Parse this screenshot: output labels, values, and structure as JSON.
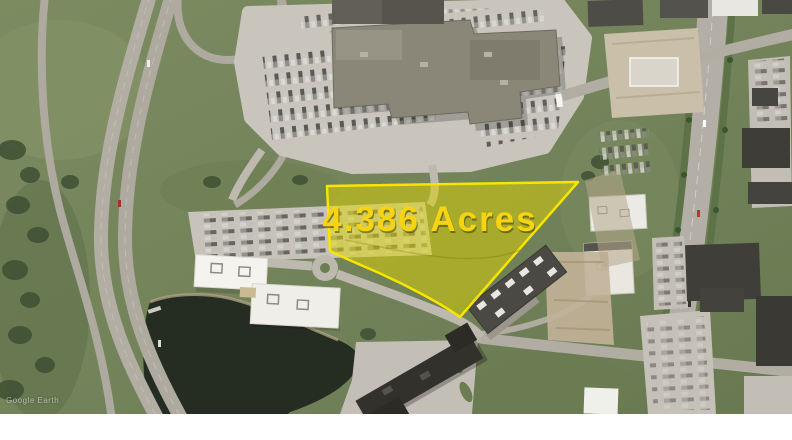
{
  "annotation": {
    "acreage_label": "4.386 Acres",
    "label_color": "#f6d411",
    "label_shadow_color": "#3c3c10",
    "outline_color": "#f8e400",
    "fill_color": "#ded400",
    "fill_opacity": "0.5",
    "parcel_path": "M327,186 L578,182 L460,317 C440,303 405,284 370,269 C356,263 342,257 330,251 Z"
  },
  "watermark": {
    "text": "Google Earth",
    "color": "#ffffff"
  },
  "scene": {
    "type": "satellite-aerial-photo",
    "palette": {
      "grass": "#75855a",
      "road": "#b3afa5",
      "parking_lot": "#c9c5bc",
      "dark_roof": "#4a4843",
      "white_roof": "#f0efe9",
      "pond": "#252d22",
      "dirt": "#c4b69c",
      "median_green": "#5d7247",
      "tree": "#3e5033"
    },
    "photo_height_px": 414,
    "canvas": {
      "width": 792,
      "height": 440,
      "margin_color": "#ffffff"
    }
  }
}
